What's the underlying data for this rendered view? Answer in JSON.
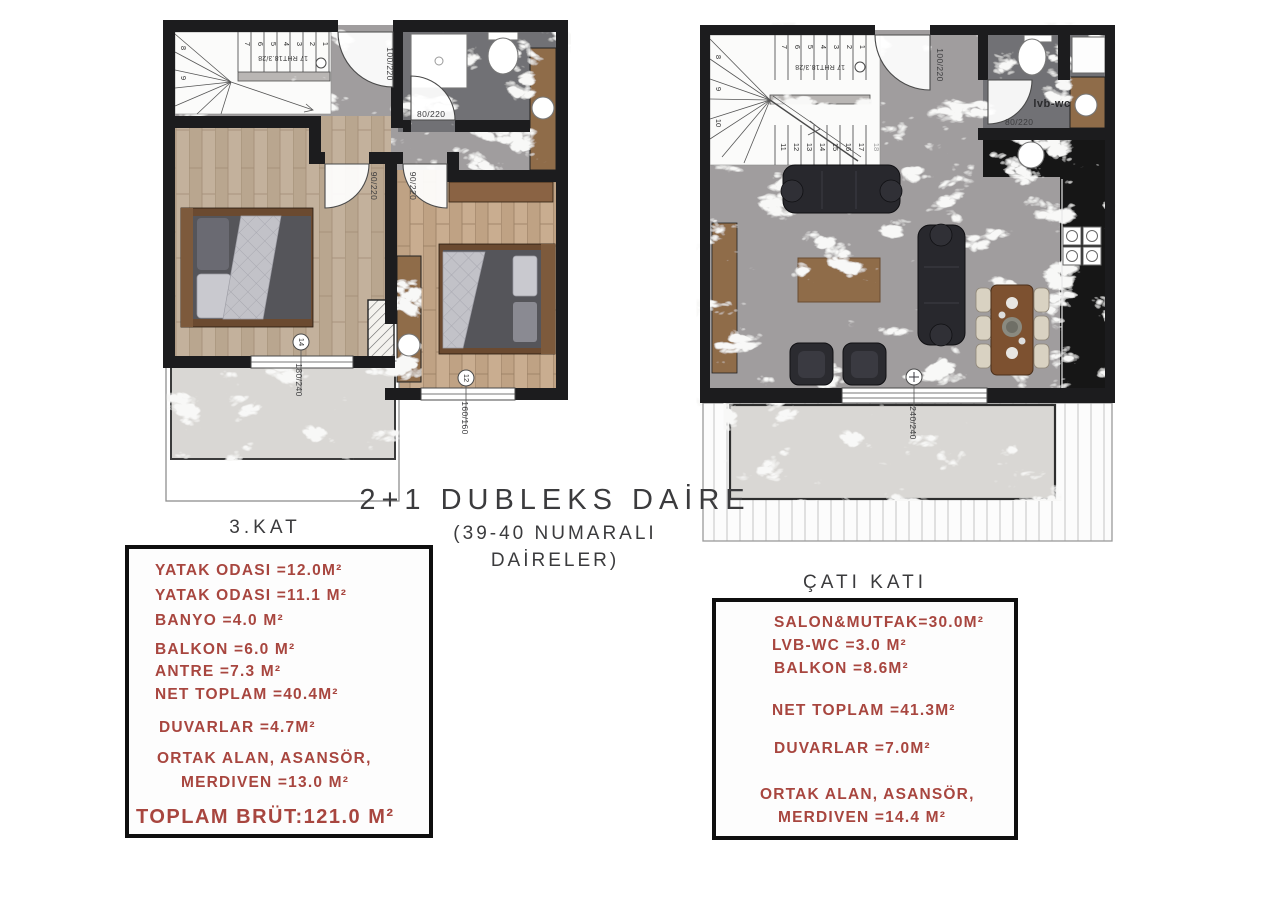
{
  "sheet": {
    "title_line1": "2+1 DUBLEKS DAİRE",
    "title_line2": "(39-40 NUMARALI",
    "title_line3": "DAİRELER)"
  },
  "left_unit": {
    "heading": "3.KAT",
    "lines": [
      "YATAK ODASI =12.0M²",
      "YATAK ODASI =11.1 M²",
      "BANYO =4.0 M²",
      "BALKON =6.0 M²",
      "ANTRE =7.3 M²",
      "NET TOPLAM =40.4M²",
      "DUVARLAR =4.7M²",
      "ORTAK ALAN, ASANSÖR,",
      "MERDIVEN =13.0 M²"
    ],
    "total": "TOPLAM BRÜT:121.0 M²"
  },
  "right_unit": {
    "heading": "ÇATI KATI",
    "lines": [
      "SALON&MUTFAK=30.0M²",
      "LVB-WC =3.0 M²",
      "BALKON =8.6M²",
      "NET TOPLAM =41.3M²",
      "DUVARLAR =7.0M²",
      "ORTAK ALAN, ASANSÖR,",
      "MERDIVEN =14.4 M²"
    ]
  },
  "plan_labels": {
    "stair_note": "17 RHT18.3/28",
    "entry_door": "100/220",
    "bath_door": "80/220",
    "bedroom_door": "90/220",
    "lvb_wc": "lvb-wc",
    "window_bedroom1": "180/240",
    "window_bedroom2": "160/160",
    "balcony_door": "240/240",
    "window_tag1": "14",
    "window_tag2": "12",
    "left_stair_numbers": [
      "1",
      "2",
      "3",
      "4",
      "5",
      "6",
      "7",
      "8",
      "9"
    ],
    "right_stair_numbers": [
      "1",
      "2",
      "3",
      "4",
      "5",
      "6",
      "7",
      "8",
      "9",
      "10",
      "11",
      "12",
      "13",
      "14",
      "15",
      "16",
      "17",
      "18"
    ]
  },
  "colors": {
    "accent_red": "#a8463f",
    "heading_gray": "#3b3b3d",
    "wall_black": "#1c1c1e",
    "marble_gray": "#a09d9e",
    "marble_light": "#d9d7d4",
    "tile_dark": "#717174",
    "marble_black": "#141416",
    "marble_brown": "#8f6c49",
    "wood_floor": "#c3b19c"
  }
}
